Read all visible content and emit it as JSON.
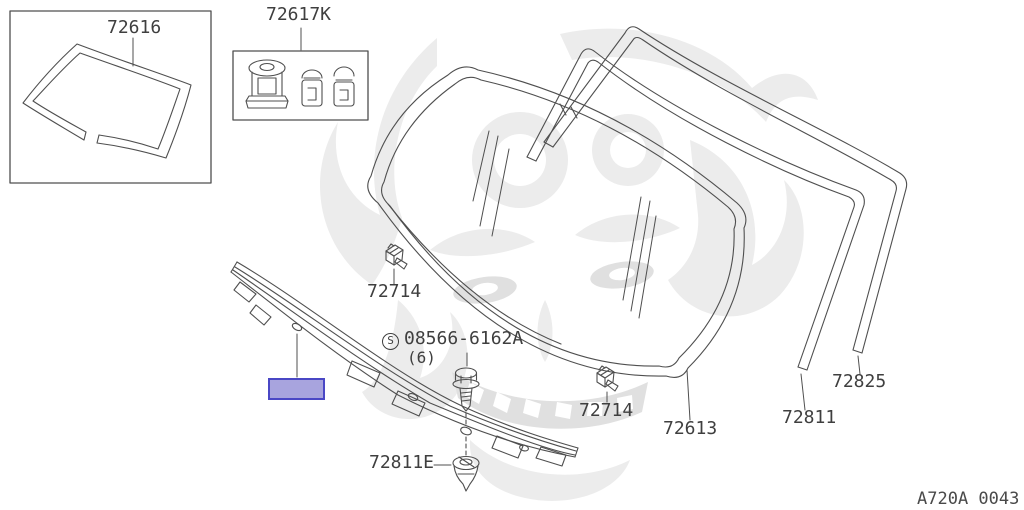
{
  "callouts": {
    "p72616": "72616",
    "p72617k": "72617K",
    "p72714_top": "72714",
    "p72714_mid": "72714",
    "screw_prefix": "S",
    "screw_code": "08566-6162A",
    "screw_qty": "(6)",
    "p72811e": "72811E",
    "p72613": "72613",
    "p72811": "72811",
    "p72825": "72825"
  },
  "footer": {
    "drawing_code": "A720A 0043"
  },
  "colors": {
    "line": "#4f4f4f",
    "text": "#3f3f3f",
    "highlight_fill": "#a8a4de",
    "highlight_border": "#4a47c5",
    "watermark": "#ececec"
  }
}
